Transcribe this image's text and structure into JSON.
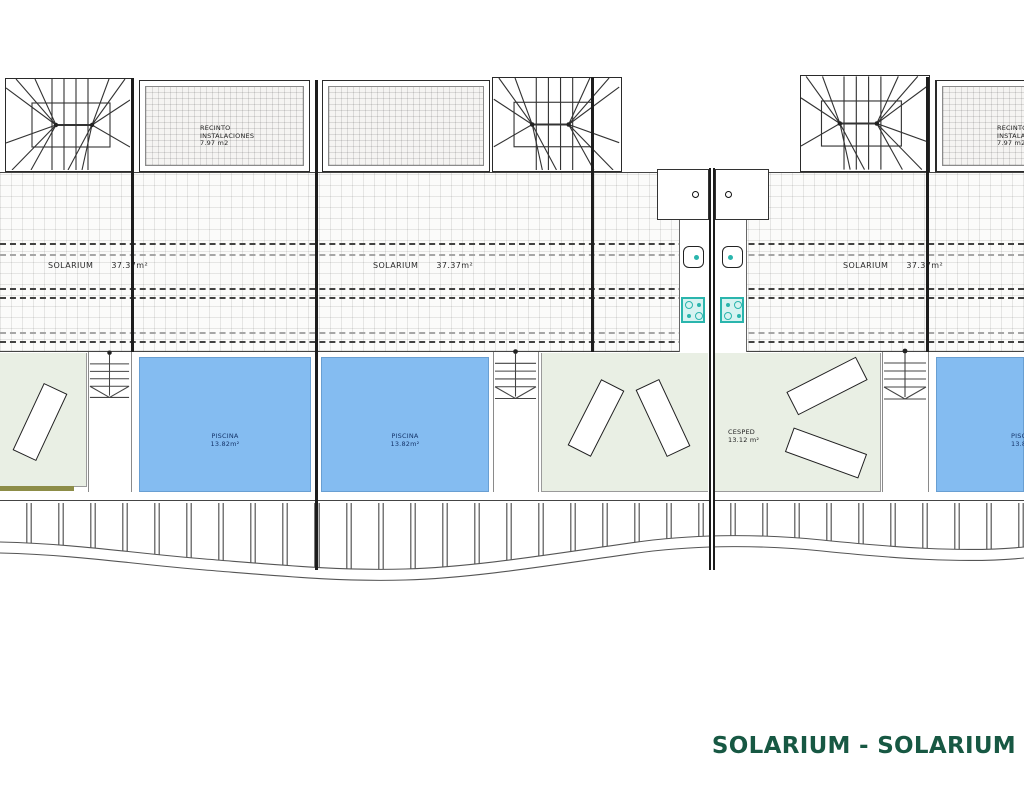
{
  "drawing": {
    "title": "SOLARIUM - SOLARIUM"
  },
  "rooms": {
    "recinto_1": {
      "lines": [
        "RECINTO",
        "INSTALACIONES",
        "7.97 m2"
      ]
    },
    "recinto_2": {
      "lines": [
        "RECINTO",
        "INSTALACIONES",
        "7.97 m2"
      ]
    },
    "solariums": [
      {
        "name": "SOLARIUM",
        "area": "37.37m²"
      },
      {
        "name": "SOLARIUM",
        "area": "37.37m²"
      },
      {
        "name": "SOLARIUM",
        "area": "37.37m²"
      }
    ],
    "pools": [
      {
        "name": "PISCINA",
        "area": "13.82m²"
      },
      {
        "name": "PISCINA",
        "area": "13.82m²"
      },
      {
        "name": "PISCINA",
        "area": "13.82m²"
      }
    ],
    "lawn": {
      "name": "CESPED",
      "area": "13.12 m²"
    }
  },
  "colors": {
    "pool_blue": "#84bcf1",
    "terrace_green": "#e9efe4",
    "fixture_teal": "#2ab5ad",
    "title_green": "#175843"
  }
}
